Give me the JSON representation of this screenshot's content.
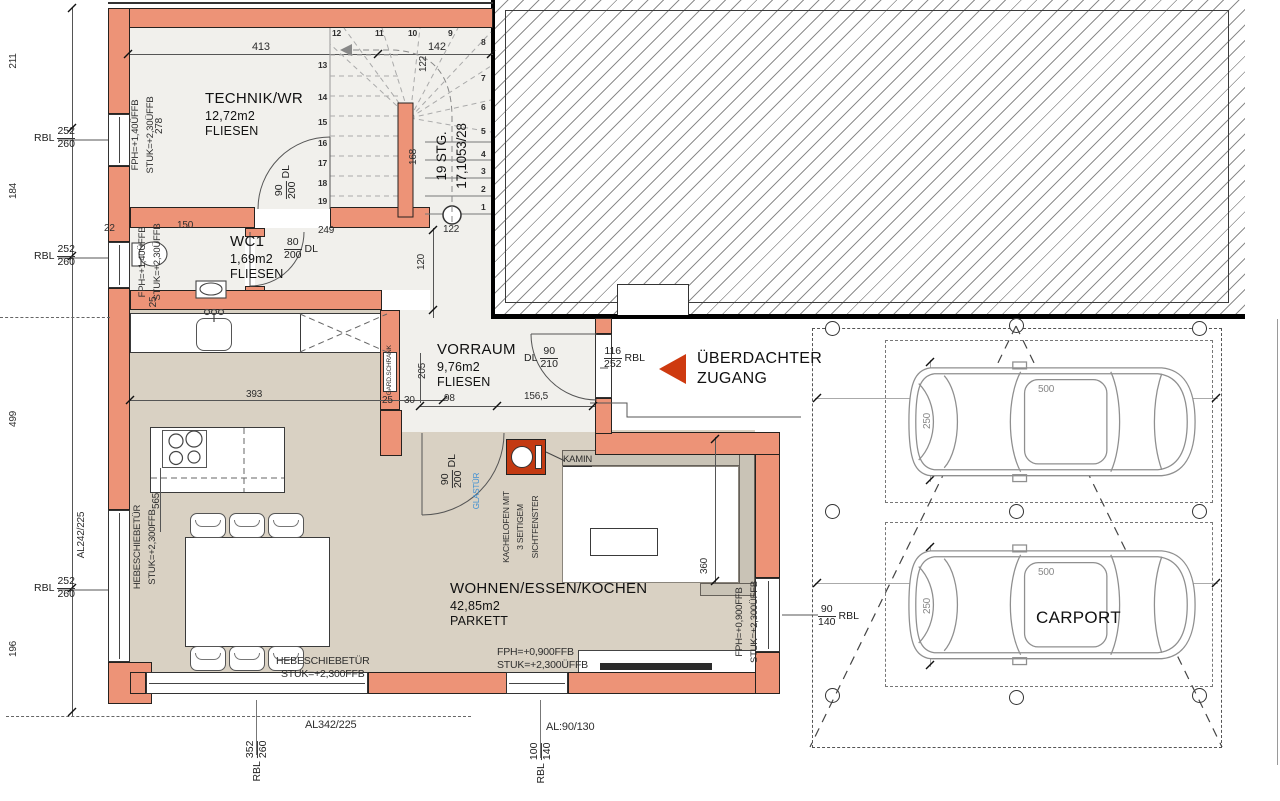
{
  "rooms": {
    "technik": {
      "name": "TECHNIK/WR",
      "area": "12,72m2",
      "floor": "FLIESEN"
    },
    "wc": {
      "name": "WC1",
      "area": "1,69m2",
      "floor": "FLIESEN"
    },
    "vorraum": {
      "name": "VORRAUM",
      "area": "9,76m2",
      "floor": "FLIESEN"
    },
    "wohnen": {
      "name": "WOHNEN/ESSEN/KOCHEN",
      "area": "42,85m2",
      "floor": "PARKETT"
    },
    "carport": {
      "name": "CARPORT"
    }
  },
  "stairs": {
    "line1": "19 STG.",
    "line2": "17,1053/28",
    "left": [
      "13",
      "14",
      "15",
      "16",
      "17",
      "18",
      "19"
    ],
    "top": [
      "12",
      "11",
      "10",
      "9"
    ],
    "right": [
      "8",
      "7",
      "6",
      "5",
      "4",
      "3",
      "2",
      "1"
    ]
  },
  "entrance": {
    "label1": "ÜBERDACHTER",
    "label2": "ZUGANG"
  },
  "fixtures": {
    "kamin": "KAMIN",
    "kachelofen1": "KACHELOFEN MIT",
    "kachelofen2": "3 SEITIGEM",
    "kachelofen3": "SICHTFENSTER",
    "glastuer": "GLASTÜR",
    "schrank": "GARD.SCHRANK"
  },
  "texts": {
    "fph140": "FPH=+1,40ÜFFB",
    "stuk230": "STUK=+2,30ÜFFB",
    "hst": "HEBESCHIEBETÜR",
    "stuk2300": "STUK=+2,300FFB",
    "fph0900": "FPH=+0,900FFB",
    "stuk2300u": "STUK=+2,300ÜFFB",
    "al242": "AL242/225",
    "al342": "AL342/225",
    "al90130": "AL:90/130"
  },
  "dims": {
    "d413": "413",
    "d142": "142",
    "d211": "211",
    "d184": "184",
    "d499": "499",
    "d196": "196",
    "d122": "122",
    "d168": "168",
    "d120": "120",
    "d249": "249",
    "d150": "150",
    "d22": "22",
    "d25": "25",
    "d30": "30",
    "d278": "278",
    "d393": "393",
    "d205": "205",
    "d98": "98",
    "d1565": "156,5",
    "d360": "360",
    "d565": "565",
    "d500": "500",
    "d250": "250"
  },
  "callouts": {
    "rbl252": {
      "t": "RBL",
      "n": "252",
      "d": "260"
    },
    "rbl352": {
      "t": "RBL",
      "n": "352",
      "d": "260"
    },
    "rbl100": {
      "t": "RBL",
      "n": "100",
      "d": "140"
    },
    "rbl90140": {
      "t": "RBL",
      "n": "90",
      "d": "140"
    },
    "rbl116": {
      "t": "RBL",
      "n": "116",
      "d": "252"
    },
    "dl90210": {
      "t": "DL",
      "n": "90",
      "d": "210"
    },
    "dl90200": {
      "t": "DL",
      "n": "90",
      "d": "200"
    },
    "dl80200": {
      "t": "DL",
      "n": "80",
      "d": "200"
    }
  },
  "colors": {
    "wall": "#ED9377",
    "accent_red": "#CE3A10",
    "glas_blue": "#3F8FD2"
  }
}
